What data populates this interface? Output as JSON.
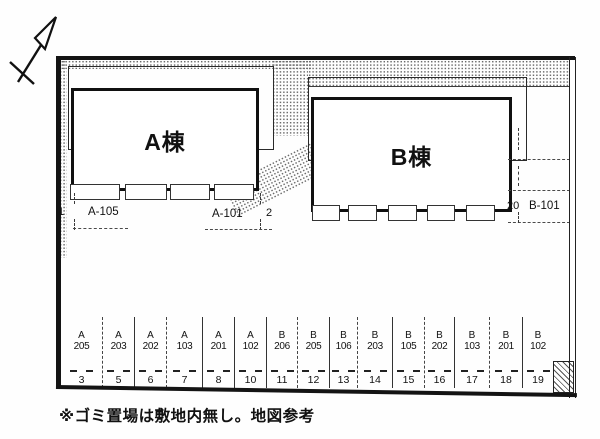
{
  "buildings": {
    "a_label": "A棟",
    "b_label": "B棟"
  },
  "front_spaces": [
    {
      "number": "1",
      "unit": "A-105"
    },
    {
      "number": "2",
      "unit": "A-101"
    }
  ],
  "side_space": {
    "number": "20",
    "unit": "B-101"
  },
  "parking_row": [
    {
      "bldg": "A",
      "unit": "205",
      "number": "3"
    },
    {
      "bldg": "A",
      "unit": "203",
      "number": "5"
    },
    {
      "bldg": "A",
      "unit": "202",
      "number": "6"
    },
    {
      "bldg": "A",
      "unit": "103",
      "number": "7"
    },
    {
      "bldg": "A",
      "unit": "201",
      "number": "8"
    },
    {
      "bldg": "A",
      "unit": "102",
      "number": "10"
    },
    {
      "bldg": "B",
      "unit": "206",
      "number": "11"
    },
    {
      "bldg": "B",
      "unit": "205",
      "number": "12"
    },
    {
      "bldg": "B",
      "unit": "106",
      "number": "13"
    },
    {
      "bldg": "B",
      "unit": "203",
      "number": "14"
    },
    {
      "bldg": "B",
      "unit": "105",
      "number": "15"
    },
    {
      "bldg": "B",
      "unit": "202",
      "number": "16"
    },
    {
      "bldg": "B",
      "unit": "103",
      "number": "17"
    },
    {
      "bldg": "B",
      "unit": "201",
      "number": "18"
    },
    {
      "bldg": "B",
      "unit": "102",
      "number": "19"
    }
  ],
  "note": "※ゴミ置場は敷地内無し。地図参考"
}
